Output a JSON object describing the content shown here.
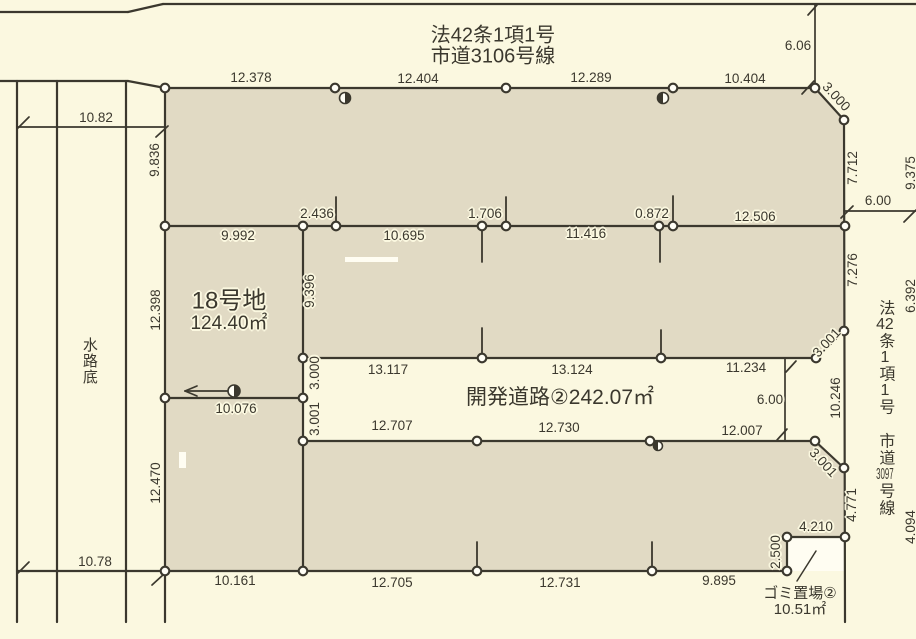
{
  "colors": {
    "background": "#fbf8e0",
    "parcel": "#e1dac4",
    "road": "#fbf8e0",
    "line": "#3b382e",
    "text": "#3b382e",
    "halo": "#fbf8e0",
    "vertex_fill": "#fffef6",
    "white_patch": "#fffdf2"
  },
  "shapes": [
    {
      "name": "parcel-block",
      "points": "165,88 815,88 844,120 845,537 787,537 787,572 165,572",
      "fill": "parcel"
    },
    {
      "name": "dev-road-band",
      "points": "303,358 845,358 845,441 303,441",
      "fill": "road"
    },
    {
      "name": "chamfer-notch-top",
      "points": "816,358 845,358 845,330",
      "fill": "road"
    },
    {
      "name": "chamfer-notch-bottom",
      "points": "815,441 845,441 845,468",
      "fill": "road"
    },
    {
      "name": "garbage-area",
      "points": "787,537 845,537 845,571 787,571",
      "fill": "white_patch"
    },
    {
      "name": "white-patch-1",
      "points": "345,257 398,257 398,262 345,262",
      "fill": "white_patch"
    },
    {
      "name": "white-patch-2",
      "points": "179,452 186,452 186,468 179,468",
      "fill": "white_patch"
    }
  ],
  "lines": [
    {
      "x1": 0,
      "y1": 12,
      "x2": 128,
      "y2": 12
    },
    {
      "x1": 128,
      "y1": 12,
      "x2": 163,
      "y2": 4
    },
    {
      "x1": 163,
      "y1": 4,
      "x2": 916,
      "y2": 4
    },
    {
      "x1": 0,
      "y1": 81,
      "x2": 128,
      "y2": 81
    },
    {
      "x1": 128,
      "y1": 81,
      "x2": 165,
      "y2": 88
    },
    {
      "x1": 165,
      "y1": 88,
      "x2": 815,
      "y2": 88
    },
    {
      "x1": 815,
      "y1": 88,
      "x2": 844,
      "y2": 120
    },
    {
      "x1": 844,
      "y1": 120,
      "x2": 845,
      "y2": 622
    },
    {
      "x1": 165,
      "y1": 88,
      "x2": 165,
      "y2": 622
    },
    {
      "x1": 165,
      "y1": 226,
      "x2": 845,
      "y2": 226
    },
    {
      "x1": 303,
      "y1": 358,
      "x2": 816,
      "y2": 358
    },
    {
      "x1": 165,
      "y1": 398,
      "x2": 303,
      "y2": 398
    },
    {
      "x1": 303,
      "y1": 441,
      "x2": 815,
      "y2": 441
    },
    {
      "x1": 17,
      "y1": 571,
      "x2": 787,
      "y2": 571
    },
    {
      "x1": 303,
      "y1": 226,
      "x2": 303,
      "y2": 572
    },
    {
      "x1": 844,
      "y1": 331,
      "x2": 816,
      "y2": 358
    },
    {
      "x1": 815,
      "y1": 441,
      "x2": 844,
      "y2": 468
    },
    {
      "x1": 787,
      "y1": 537,
      "x2": 845,
      "y2": 537
    },
    {
      "x1": 787,
      "y1": 537,
      "x2": 787,
      "y2": 571
    },
    {
      "x1": 17,
      "y1": 81,
      "x2": 17,
      "y2": 622
    },
    {
      "x1": 57,
      "y1": 81,
      "x2": 57,
      "y2": 622
    },
    {
      "x1": 126,
      "y1": 81,
      "x2": 126,
      "y2": 622
    },
    {
      "x1": 17,
      "y1": 127,
      "x2": 165,
      "y2": 127,
      "w": 1.7
    },
    {
      "x1": 815,
      "y1": 4,
      "x2": 815,
      "y2": 88,
      "w": 1.7
    },
    {
      "x1": 845,
      "y1": 211,
      "x2": 916,
      "y2": 211,
      "w": 1.7
    },
    {
      "x1": 785,
      "y1": 358,
      "x2": 785,
      "y2": 441,
      "w": 1.7
    },
    {
      "x1": 185,
      "y1": 391,
      "x2": 237,
      "y2": 391,
      "w": 1.7
    },
    {
      "x1": 185,
      "y1": 391,
      "x2": 197,
      "y2": 386,
      "w": 1.7
    },
    {
      "x1": 185,
      "y1": 391,
      "x2": 197,
      "y2": 396,
      "w": 1.7
    },
    {
      "x1": 336,
      "y1": 197,
      "x2": 336,
      "y2": 226,
      "w": 1.8
    },
    {
      "x1": 506,
      "y1": 197,
      "x2": 506,
      "y2": 226,
      "w": 1.8
    },
    {
      "x1": 673,
      "y1": 196,
      "x2": 673,
      "y2": 226,
      "w": 1.8
    },
    {
      "x1": 482,
      "y1": 226,
      "x2": 482,
      "y2": 262,
      "w": 1.8
    },
    {
      "x1": 660,
      "y1": 226,
      "x2": 660,
      "y2": 262,
      "w": 1.8
    },
    {
      "x1": 482,
      "y1": 328,
      "x2": 482,
      "y2": 358,
      "w": 1.8
    },
    {
      "x1": 661,
      "y1": 330,
      "x2": 661,
      "y2": 358,
      "w": 1.8
    },
    {
      "x1": 477,
      "y1": 542,
      "x2": 477,
      "y2": 571,
      "w": 1.8
    },
    {
      "x1": 652,
      "y1": 542,
      "x2": 652,
      "y2": 571,
      "w": 1.8
    },
    {
      "x1": 18,
      "y1": 128,
      "x2": 29,
      "y2": 117,
      "w": 1.7
    },
    {
      "x1": 156,
      "y1": 137,
      "x2": 168,
      "y2": 126,
      "w": 1.7
    },
    {
      "x1": 18,
      "y1": 573,
      "x2": 29,
      "y2": 562,
      "w": 1.7
    },
    {
      "x1": 152,
      "y1": 585,
      "x2": 164,
      "y2": 574,
      "w": 1.7
    },
    {
      "x1": 808,
      "y1": 15,
      "x2": 817,
      "y2": 5,
      "w": 1.7
    },
    {
      "x1": 802,
      "y1": 94,
      "x2": 814,
      "y2": 81,
      "w": 1.7
    },
    {
      "x1": 841,
      "y1": 218,
      "x2": 853,
      "y2": 206,
      "w": 1.7
    },
    {
      "x1": 904,
      "y1": 222,
      "x2": 916,
      "y2": 210,
      "w": 1.7
    },
    {
      "x1": 786,
      "y1": 372,
      "x2": 796,
      "y2": 361,
      "w": 1.7
    },
    {
      "x1": 777,
      "y1": 440,
      "x2": 787,
      "y2": 429,
      "w": 1.7
    },
    {
      "x1": 816,
      "y1": 551,
      "x2": 797,
      "y2": 581,
      "w": 1.5
    }
  ],
  "vertices": [
    [
      165,
      88
    ],
    [
      335,
      88
    ],
    [
      506,
      88
    ],
    [
      673,
      88
    ],
    [
      815,
      88
    ],
    [
      844,
      120
    ],
    [
      165,
      226
    ],
    [
      303,
      226
    ],
    [
      336,
      226
    ],
    [
      482,
      226
    ],
    [
      506,
      226
    ],
    [
      659,
      226
    ],
    [
      673,
      226
    ],
    [
      845,
      226
    ],
    [
      844,
      331
    ],
    [
      303,
      358
    ],
    [
      482,
      358
    ],
    [
      661,
      358
    ],
    [
      816,
      358
    ],
    [
      165,
      398
    ],
    [
      303,
      398
    ],
    [
      303,
      441
    ],
    [
      477,
      441
    ],
    [
      650,
      441
    ],
    [
      815,
      441
    ],
    [
      844,
      468
    ],
    [
      165,
      571
    ],
    [
      303,
      571
    ],
    [
      477,
      571
    ],
    [
      652,
      571
    ],
    [
      787,
      571
    ],
    [
      787,
      537
    ],
    [
      845,
      537
    ]
  ],
  "markers": [
    {
      "x": 345,
      "y": 98,
      "r": 5.5,
      "side": "right"
    },
    {
      "x": 663,
      "y": 98,
      "r": 5.5,
      "side": "left"
    },
    {
      "x": 234,
      "y": 391,
      "r": 6,
      "side": "right"
    },
    {
      "x": 658,
      "y": 446,
      "r": 4.5,
      "side": "left"
    }
  ],
  "labels": [
    {
      "text": "法42条1項1号",
      "x": 493,
      "y": 36,
      "size": 20,
      "name": "road-top-name-line1"
    },
    {
      "text": "市道3106号線",
      "x": 493,
      "y": 57,
      "size": 20,
      "name": "road-top-name-line2"
    },
    {
      "text": "12.378",
      "x": 251,
      "y": 78
    },
    {
      "text": "12.404",
      "x": 418,
      "y": 79
    },
    {
      "text": "12.289",
      "x": 591,
      "y": 78
    },
    {
      "text": "10.404",
      "x": 745,
      "y": 79
    },
    {
      "text": "6.06",
      "x": 798,
      "y": 46
    },
    {
      "text": "3.000",
      "x": 836,
      "y": 97,
      "rot": 47
    },
    {
      "text": "10.82",
      "x": 96,
      "y": 118
    },
    {
      "text": "9.836",
      "x": 155,
      "y": 160,
      "rot": -90
    },
    {
      "text": "7.712",
      "x": 853,
      "y": 168,
      "rot": -90
    },
    {
      "text": "9.375",
      "x": 911,
      "y": 173,
      "rot": -90
    },
    {
      "text": "6.00",
      "x": 878,
      "y": 201
    },
    {
      "text": "9.992",
      "x": 238,
      "y": 236
    },
    {
      "text": "2.436",
      "x": 317,
      "y": 214
    },
    {
      "text": "10.695",
      "x": 404,
      "y": 236
    },
    {
      "text": "1.706",
      "x": 485,
      "y": 214
    },
    {
      "text": "11.416",
      "x": 586,
      "y": 234
    },
    {
      "text": "0.872",
      "x": 652,
      "y": 214
    },
    {
      "text": "12.506",
      "x": 755,
      "y": 217
    },
    {
      "text": "7.276",
      "x": 853,
      "y": 270,
      "rot": -90
    },
    {
      "text": "6.392",
      "x": 911,
      "y": 296,
      "rot": -90
    },
    {
      "text": "9.396",
      "x": 310,
      "y": 291,
      "rot": -90
    },
    {
      "text": "12.398",
      "x": 156,
      "y": 310,
      "rot": -90
    },
    {
      "text": "18号地",
      "x": 229,
      "y": 301,
      "size": 24,
      "name": "lot-18-name"
    },
    {
      "text": "124.40㎡",
      "x": 229,
      "y": 324,
      "size": 19,
      "name": "lot-18-area"
    },
    {
      "text": "13.117",
      "x": 388,
      "y": 370
    },
    {
      "text": "13.124",
      "x": 572,
      "y": 370
    },
    {
      "text": "11.234",
      "x": 746,
      "y": 368
    },
    {
      "text": "3.001",
      "x": 827,
      "y": 343,
      "rot": -47
    },
    {
      "text": "3.000",
      "x": 315,
      "y": 373,
      "rot": -90
    },
    {
      "text": "3.001",
      "x": 315,
      "y": 419,
      "rot": -90
    },
    {
      "text": "10.076",
      "x": 236,
      "y": 409
    },
    {
      "text": "開発道路②242.07㎡",
      "x": 560,
      "y": 398,
      "size": 21,
      "name": "dev-road-label"
    },
    {
      "text": "6.00",
      "x": 770,
      "y": 400
    },
    {
      "text": "10.246",
      "x": 836,
      "y": 398,
      "rot": -90
    },
    {
      "text": "12.707",
      "x": 392,
      "y": 426
    },
    {
      "text": "12.730",
      "x": 559,
      "y": 428
    },
    {
      "text": "12.007",
      "x": 742,
      "y": 431
    },
    {
      "text": "3.001",
      "x": 823,
      "y": 463,
      "rot": 47
    },
    {
      "text": "12.470",
      "x": 156,
      "y": 483,
      "rot": -90
    },
    {
      "text": "4.771",
      "x": 852,
      "y": 505,
      "rot": -90
    },
    {
      "text": "4.094",
      "x": 911,
      "y": 527,
      "rot": -90
    },
    {
      "text": "4.210",
      "x": 816,
      "y": 527
    },
    {
      "text": "2.500",
      "x": 776,
      "y": 552,
      "rot": -90
    },
    {
      "text": "ゴミ置場②",
      "x": 800,
      "y": 594,
      "size": 15,
      "name": "garbage-name"
    },
    {
      "text": "10.51㎡",
      "x": 800,
      "y": 610,
      "size": 15,
      "name": "garbage-area-label"
    },
    {
      "text": "10.161",
      "x": 235,
      "y": 581
    },
    {
      "text": "12.705",
      "x": 392,
      "y": 583
    },
    {
      "text": "12.731",
      "x": 560,
      "y": 583
    },
    {
      "text": "9.895",
      "x": 719,
      "y": 581
    },
    {
      "text": "10.78",
      "x": 95,
      "y": 562
    },
    {
      "text": "水路底",
      "x": 89,
      "y": 361,
      "size": 15,
      "vertical": true,
      "name": "water-channel-label"
    },
    {
      "segments": [
        "法",
        "42",
        "条",
        "1",
        "項",
        "1",
        "号",
        "　",
        "市",
        "道",
        "3097",
        "号",
        "線"
      ],
      "x": 884,
      "y": 408,
      "size": 16,
      "vertical": true,
      "name": "road-right-name"
    }
  ]
}
